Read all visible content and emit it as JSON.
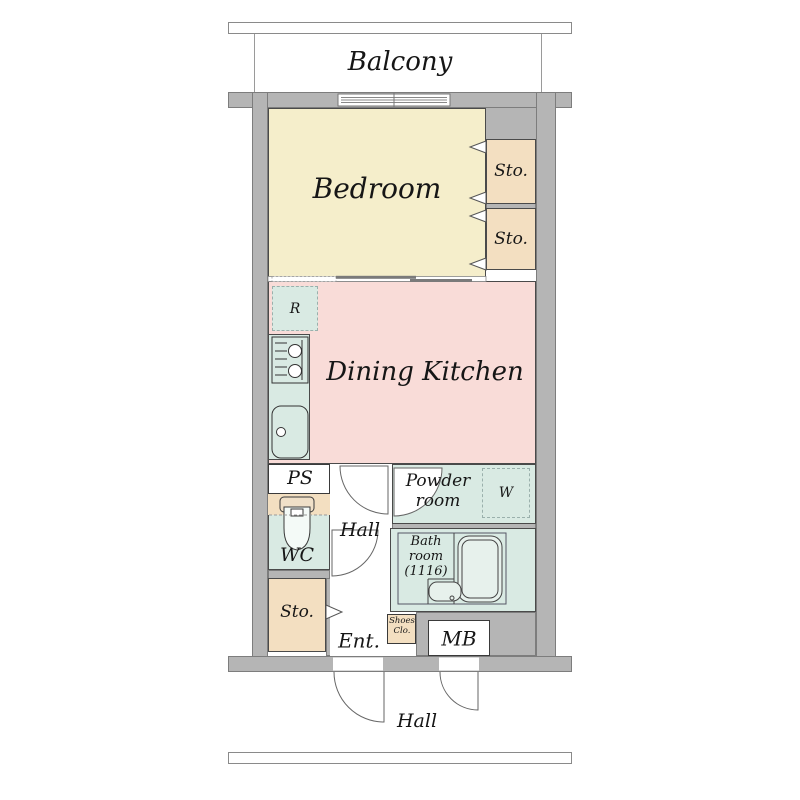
{
  "plan_title": "1DK apartment floor plan",
  "rooms": {
    "balcony": {
      "label": "Balcony"
    },
    "bedroom": {
      "label": "Bedroom"
    },
    "storage_top_1": {
      "label": "Sto."
    },
    "storage_top_2": {
      "label": "Sto."
    },
    "dining_kitchen": {
      "label": "Dining Kitchen"
    },
    "refrigerator_space": {
      "label": "R"
    },
    "pipe_space": {
      "label": "PS"
    },
    "wc": {
      "label": "WC"
    },
    "hall_inner": {
      "label": "Hall"
    },
    "powder_room": {
      "label": "Powder room"
    },
    "washer_space": {
      "label": "W"
    },
    "bath_room": {
      "label": "Bath room (1116)"
    },
    "storage_entrance": {
      "label": "Sto."
    },
    "entrance": {
      "label": "Ent."
    },
    "shoes_closet": {
      "label": "Shoes Clo."
    },
    "meter_box": {
      "label": "MB"
    },
    "hall_outer": {
      "label": "Hall"
    }
  },
  "colors": {
    "wall": "#b5b5b5",
    "wall_edge": "#7d7d7d",
    "bedroom": "#f5eecb",
    "storage": "#f3dfc1",
    "dining": "#f9dcd8",
    "wet": "#d9eae3",
    "line": "#4a4a4a"
  }
}
